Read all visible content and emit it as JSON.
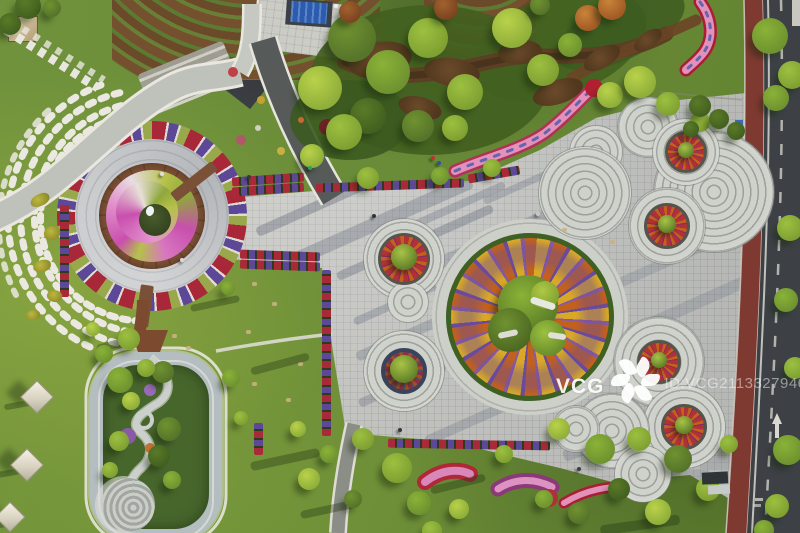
{
  "image": {
    "description": "Aerial top-down photograph of a landscaped city park plaza at golden hour: spiral flower roundabout, mandala-pattern circular flower bed, overlapping concentric-circle paving, flower planter rows, winding sunken garden, lawns with tents, and a street with red cycle lane on the right",
    "width_px": 800,
    "height_px": 533
  },
  "watermark": {
    "brand": "VCG",
    "id_label": "ID:VCG211332794686",
    "tail_mark": "|"
  },
  "palette": {
    "lawn": "#6a8c38",
    "lawn_light": "#8aa647",
    "lawn_dark": "#4f6b2b",
    "pavement": "#c7c7c1",
    "pavement_dark": "#9da19b",
    "asphalt_road": "#3d4146",
    "cycle_lane_red": "#7e3a31",
    "flower_red": "#a82a38",
    "flower_purple": "#5c4896",
    "flower_pink": "#e273aa",
    "flower_magenta": "#c84fae",
    "flower_yellow": "#d9a826",
    "flower_orange": "#c2611d",
    "tree_green": "#6f9230",
    "hedge_dark": "#42601f",
    "mulch_brown": "#5b4023",
    "spiral_chartreuse": "#b5c14a",
    "rim_concrete": "#b4bec0",
    "tent_white": "#f2eee2"
  },
  "scene": {
    "ring_sets": [
      [
        404,
        259,
        40
      ],
      [
        408,
        302,
        20
      ],
      [
        404,
        371,
        40
      ],
      [
        596,
        152,
        26
      ],
      [
        585,
        193,
        46
      ],
      [
        648,
        127,
        30
      ],
      [
        714,
        192,
        60
      ],
      [
        686,
        152,
        33
      ],
      [
        667,
        226,
        38
      ],
      [
        659,
        362,
        45
      ],
      [
        684,
        427,
        41
      ],
      [
        612,
        431,
        37
      ],
      [
        576,
        429,
        23
      ],
      [
        643,
        474,
        28
      ]
    ],
    "flower_circles": [
      {
        "x": 404,
        "y": 259,
        "bed": 26,
        "core": 13
      },
      {
        "x": 404,
        "y": 371,
        "bed": 23,
        "core": 14,
        "dark": true
      },
      {
        "x": 686,
        "y": 152,
        "bed": 21,
        "core": 8
      },
      {
        "x": 667,
        "y": 226,
        "bed": 23,
        "core": 9
      },
      {
        "x": 659,
        "y": 362,
        "bed": 22,
        "core": 8
      },
      {
        "x": 684,
        "y": 427,
        "bed": 23,
        "core": 9
      }
    ],
    "planter_rows": [
      {
        "x": 232,
        "y": 175,
        "len": 72,
        "rot": -4
      },
      {
        "x": 232,
        "y": 185,
        "len": 72,
        "rot": -4
      },
      {
        "x": 316,
        "y": 181,
        "len": 148,
        "rot": -2
      },
      {
        "x": 468,
        "y": 170,
        "len": 52,
        "rot": -10
      },
      {
        "x": 240,
        "y": 251,
        "len": 80,
        "rot": 2
      },
      {
        "x": 240,
        "y": 261,
        "len": 80,
        "rot": 2
      },
      {
        "x": 322,
        "y": 270,
        "len": 166,
        "rot": 0,
        "v": 1
      },
      {
        "x": 254,
        "y": 423,
        "len": 32,
        "rot": 0,
        "v": 1
      },
      {
        "x": 388,
        "y": 440,
        "len": 162,
        "rot": 1
      },
      {
        "x": 60,
        "y": 205,
        "len": 92,
        "rot": 0,
        "v": 1
      }
    ],
    "soil": [
      [
        380,
        60,
        64,
        36,
        -10
      ],
      [
        452,
        72,
        56,
        28,
        8
      ],
      [
        520,
        52,
        44,
        24,
        -5
      ],
      [
        420,
        108,
        44,
        22,
        15
      ],
      [
        558,
        92,
        52,
        24,
        -18
      ],
      [
        602,
        58,
        40,
        20,
        -30
      ],
      [
        648,
        40,
        32,
        16,
        -35
      ]
    ],
    "plaza_streaks": [
      [
        250,
        195,
        160,
        10,
        -24,
        0.28
      ],
      [
        280,
        215,
        200,
        14,
        -24,
        0.24
      ],
      [
        330,
        238,
        170,
        9,
        -24,
        0.26
      ],
      [
        390,
        205,
        120,
        8,
        -24,
        0.22
      ],
      [
        430,
        228,
        150,
        12,
        -24,
        0.2
      ],
      [
        480,
        180,
        90,
        7,
        -24,
        0.2
      ],
      [
        350,
        300,
        90,
        8,
        -24,
        0.22
      ],
      [
        352,
        330,
        110,
        10,
        -24,
        0.2
      ],
      [
        355,
        380,
        95,
        9,
        -24,
        0.22
      ],
      [
        420,
        410,
        130,
        10,
        -24,
        0.18
      ],
      [
        600,
        260,
        120,
        10,
        -24,
        0.15
      ],
      [
        620,
        300,
        140,
        12,
        -24,
        0.15
      ],
      [
        560,
        430,
        120,
        12,
        -20,
        0.2
      ],
      [
        640,
        470,
        70,
        30,
        0,
        0.12
      ],
      [
        700,
        445,
        50,
        24,
        0,
        0.1
      ]
    ],
    "lawn_shadows": [
      [
        4,
        402,
        28,
        6,
        -10
      ],
      [
        -4,
        470,
        26,
        6,
        -10
      ],
      [
        -12,
        522,
        24,
        6,
        -10
      ],
      [
        96,
        340,
        40,
        8,
        -15
      ],
      [
        190,
        300,
        50,
        7,
        -12
      ],
      [
        250,
        360,
        60,
        8,
        -15
      ],
      [
        250,
        455,
        70,
        9,
        -12
      ],
      [
        300,
        505,
        60,
        8,
        -12
      ],
      [
        600,
        520,
        80,
        10,
        -8
      ],
      [
        430,
        480,
        56,
        8,
        -14
      ]
    ],
    "trees": [
      [
        28,
        6,
        13,
        "e"
      ],
      [
        10,
        24,
        11,
        "e"
      ],
      [
        52,
        8,
        9,
        "d"
      ],
      [
        352,
        38,
        24,
        "d"
      ],
      [
        388,
        72,
        22,
        "c"
      ],
      [
        428,
        38,
        20,
        "b"
      ],
      [
        465,
        92,
        18,
        "b"
      ],
      [
        512,
        28,
        20,
        "a"
      ],
      [
        543,
        70,
        16,
        "b"
      ],
      [
        455,
        128,
        13,
        "b"
      ],
      [
        418,
        126,
        16,
        "d"
      ],
      [
        368,
        116,
        18,
        "e"
      ],
      [
        610,
        95,
        13,
        "a"
      ],
      [
        588,
        18,
        13,
        "o"
      ],
      [
        612,
        6,
        14,
        "o"
      ],
      [
        640,
        82,
        16,
        "a"
      ],
      [
        668,
        104,
        12,
        "b"
      ],
      [
        700,
        122,
        10,
        "b"
      ],
      [
        446,
        8,
        12,
        "r"
      ],
      [
        350,
        12,
        11,
        "r"
      ],
      [
        540,
        5,
        10,
        "d"
      ],
      [
        570,
        45,
        12,
        "c"
      ],
      [
        320,
        88,
        22,
        "a"
      ],
      [
        344,
        132,
        18,
        "b"
      ],
      [
        312,
        156,
        12,
        "a"
      ],
      [
        368,
        178,
        11,
        "b"
      ],
      [
        440,
        176,
        9,
        "c"
      ],
      [
        492,
        168,
        9,
        "b"
      ],
      [
        770,
        36,
        18,
        "c"
      ],
      [
        792,
        75,
        14,
        "b"
      ],
      [
        776,
        98,
        13,
        "c"
      ],
      [
        790,
        228,
        13,
        "b"
      ],
      [
        786,
        300,
        12,
        "c"
      ],
      [
        795,
        368,
        11,
        "b"
      ],
      [
        788,
        450,
        15,
        "c"
      ],
      [
        777,
        506,
        12,
        "b"
      ],
      [
        764,
        530,
        10,
        "c"
      ],
      [
        700,
        106,
        11,
        "e"
      ],
      [
        719,
        119,
        10,
        "e"
      ],
      [
        736,
        131,
        9,
        "e"
      ],
      [
        691,
        129,
        8,
        "e"
      ],
      [
        397,
        468,
        15,
        "b"
      ],
      [
        419,
        503,
        12,
        "c"
      ],
      [
        459,
        509,
        10,
        "a"
      ],
      [
        504,
        454,
        9,
        "b"
      ],
      [
        559,
        429,
        11,
        "a"
      ],
      [
        600,
        449,
        15,
        "c"
      ],
      [
        639,
        439,
        12,
        "b"
      ],
      [
        678,
        459,
        14,
        "d"
      ],
      [
        708,
        489,
        12,
        "b"
      ],
      [
        658,
        512,
        13,
        "a"
      ],
      [
        619,
        489,
        11,
        "e"
      ],
      [
        729,
        444,
        9,
        "b"
      ],
      [
        579,
        513,
        11,
        "d"
      ],
      [
        544,
        499,
        9,
        "c"
      ],
      [
        432,
        531,
        10,
        "b"
      ],
      [
        363,
        439,
        11,
        "b"
      ],
      [
        329,
        454,
        9,
        "c"
      ],
      [
        309,
        479,
        11,
        "a"
      ],
      [
        353,
        499,
        9,
        "d"
      ],
      [
        298,
        429,
        8,
        "a"
      ],
      [
        129,
        339,
        11,
        "b"
      ],
      [
        104,
        354,
        9,
        "c"
      ],
      [
        93,
        329,
        7,
        "a"
      ],
      [
        228,
        288,
        7,
        "c"
      ],
      [
        231,
        378,
        9,
        "c"
      ],
      [
        241,
        418,
        7,
        "b"
      ],
      [
        120,
        380,
        13,
        "c"
      ],
      [
        163,
        372,
        11,
        "d"
      ],
      [
        131,
        401,
        9,
        "a"
      ],
      [
        169,
        429,
        12,
        "d"
      ],
      [
        119,
        441,
        10,
        "b"
      ],
      [
        159,
        456,
        11,
        "e"
      ],
      [
        146,
        368,
        9,
        "b"
      ],
      [
        172,
        480,
        9,
        "c"
      ],
      [
        110,
        470,
        8,
        "b"
      ]
    ],
    "topiary": [
      [
        30,
        194,
        20,
        12,
        -20
      ],
      [
        44,
        226,
        16,
        14,
        10
      ],
      [
        33,
        260,
        18,
        12,
        -8
      ],
      [
        47,
        290,
        15,
        12,
        20
      ],
      [
        26,
        310,
        14,
        10,
        0
      ]
    ],
    "lawn_flowers": [
      [
        233,
        72,
        5,
        "#c04048"
      ],
      [
        261,
        100,
        4,
        "#c8a030"
      ],
      [
        241,
        140,
        5,
        "#b05868"
      ],
      [
        281,
        151,
        4,
        "#c8b040"
      ],
      [
        301,
        120,
        3,
        "#c86a30"
      ],
      [
        327,
        127,
        8,
        "#6e2226"
      ],
      [
        258,
        128,
        3,
        "#d0d0c0"
      ],
      [
        128,
        436,
        8,
        "#8a5aa8"
      ],
      [
        150,
        390,
        6,
        "#9a6ab8"
      ],
      [
        150,
        448,
        5,
        "#c07030"
      ]
    ],
    "stones": [
      [
        252,
        282
      ],
      [
        272,
        302
      ],
      [
        298,
        362
      ],
      [
        252,
        382
      ],
      [
        562,
        228
      ],
      [
        610,
        240
      ],
      [
        246,
        330
      ],
      [
        286,
        398
      ],
      [
        172,
        334
      ],
      [
        186,
        346
      ]
    ],
    "tents": [
      [
        37,
        397,
        24
      ],
      [
        27,
        465,
        24
      ],
      [
        10,
        517,
        22
      ]
    ],
    "people": [
      [
        372,
        214,
        "#30333a"
      ],
      [
        431,
        156,
        "#c03030"
      ],
      [
        437,
        161,
        "#3050a0"
      ],
      [
        247,
        175,
        "#3a3a3a"
      ],
      [
        308,
        166,
        "#2fa060"
      ],
      [
        398,
        428,
        "#33363c"
      ],
      [
        577,
        467,
        "#3a3f45"
      ],
      [
        536,
        212,
        "#c8c8c8"
      ],
      [
        180,
        258,
        "#d8d8d8"
      ],
      [
        160,
        172,
        "#e0e0e0"
      ]
    ]
  }
}
